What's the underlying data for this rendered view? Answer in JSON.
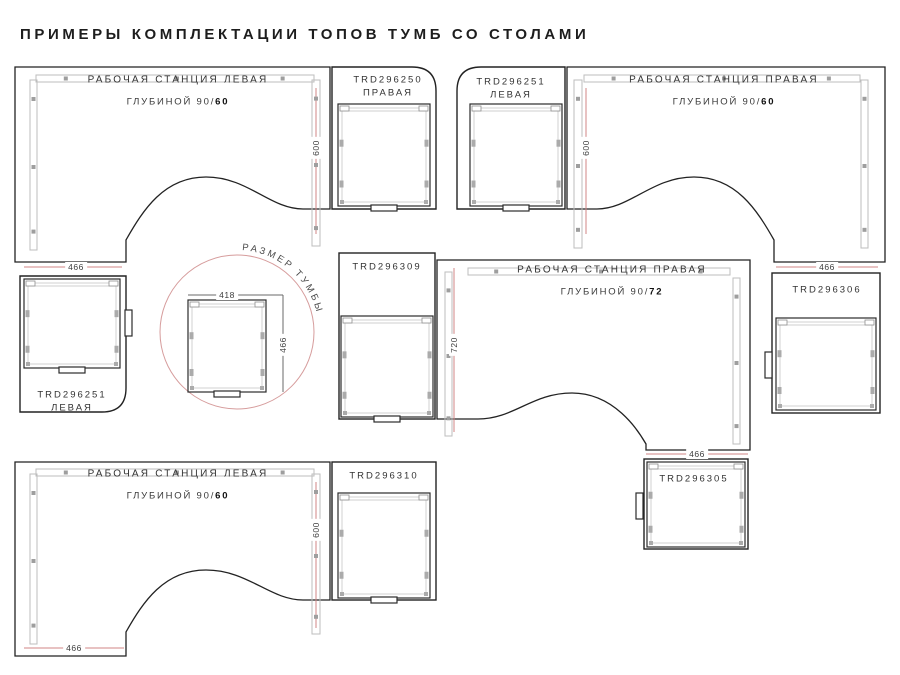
{
  "title": "ПРИМЕРЫ КОМПЛЕКТАЦИИ ТОПОВ ТУМБ СО СТОЛАМИ",
  "g1": {
    "station": "РАБОЧАЯ СТАНЦИЯ ЛЕВАЯ",
    "depth_prefix": "ГЛУБИНОЙ 90/",
    "depth_value": "60",
    "dim_depth": "600",
    "dim_return": "466",
    "cab_top_code": "TRD296250",
    "cab_top_side": "ПРАВАЯ",
    "cab_bottom_code": "TRD296251",
    "cab_bottom_side": "ЛЕВАЯ"
  },
  "g2": {
    "station": "РАБОЧАЯ СТАНЦИЯ ПРАВАЯ",
    "depth_prefix": "ГЛУБИНОЙ 90/",
    "depth_value": "60",
    "dim_depth": "600",
    "dim_return": "466",
    "cab_top_code": "TRD296251",
    "cab_top_side": "ЛЕВАЯ",
    "cab_bottom_code": "TRD296306"
  },
  "g3": {
    "label": "РАЗМЕР ТУМБЫ",
    "dim_width": "418",
    "dim_depth": "466"
  },
  "g4": {
    "station": "РАБОЧАЯ СТАНЦИЯ ПРАВАЯ",
    "depth_prefix": "ГЛУБИНОЙ 90/",
    "depth_value": "72",
    "dim_depth": "720",
    "dim_return": "466",
    "cab_top_code": "TRD296309",
    "cab_bottom_code": "TRD296305"
  },
  "g5": {
    "station": "РАБОЧАЯ СТАНЦИЯ ЛЕВАЯ",
    "depth_prefix": "ГЛУБИНОЙ 90/",
    "depth_value": "60",
    "dim_depth": "600",
    "dim_return": "466",
    "cab_top_code": "TRD296310"
  },
  "colors": {
    "outline": "#222222",
    "dim_line": "#d08585",
    "circle": "#d69c9c",
    "text": "#333333"
  }
}
